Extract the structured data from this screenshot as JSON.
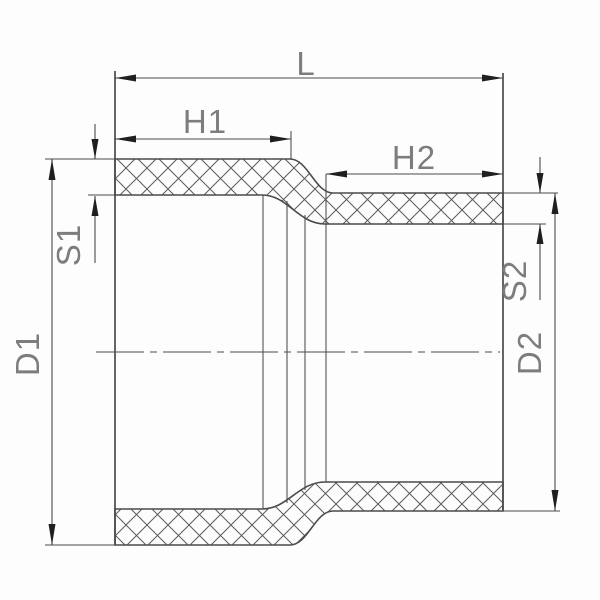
{
  "drawing": {
    "type": "technical-drawing",
    "subject": "reducing-pipe-coupling-cross-section",
    "dimension_labels": {
      "length_total": "L",
      "socket_depth_large": "H1",
      "socket_depth_small": "H2",
      "wall_thickness_large": "S1",
      "wall_thickness_small": "S2",
      "diameter_large": "D1",
      "diameter_small": "D2"
    },
    "colors": {
      "background": "#fdfdfd",
      "line": "#4b4b4b",
      "arrow": "#1f1f1f",
      "text": "#7d7d7d",
      "hatch": "#5a5a5a"
    }
  }
}
